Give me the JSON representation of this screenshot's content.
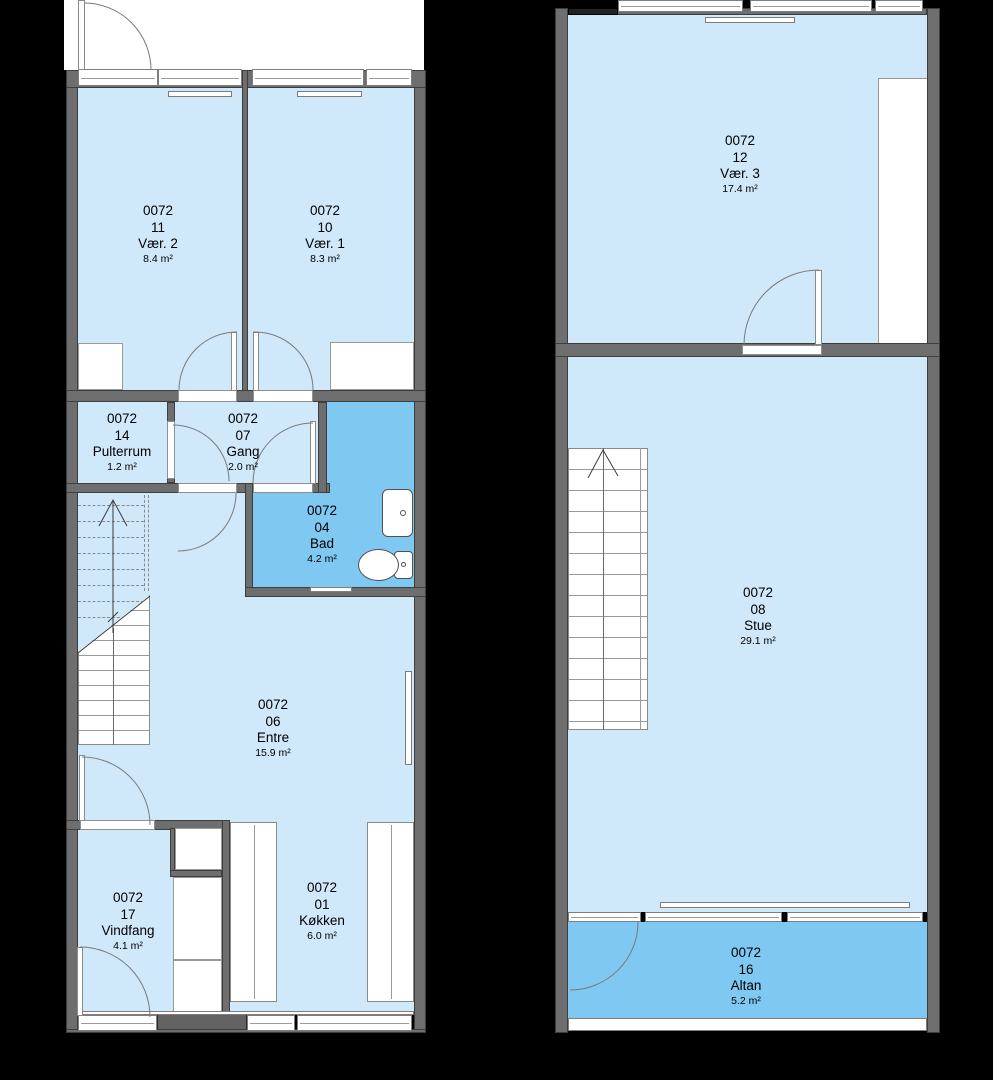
{
  "unit_id": "0072",
  "colors": {
    "background": "#000000",
    "floor_light": "#cfe8fa",
    "floor_dark": "#7fc8f1",
    "wall_gray": "#6e6e6e",
    "wall_edge": "#3e3e3e",
    "fixture_white": "#ffffff",
    "text": "#000000"
  },
  "rooms": {
    "vaer2": {
      "number": "0072",
      "room_no": "11",
      "name": "Vær. 2",
      "area": "8.4 m²"
    },
    "vaer1": {
      "number": "0072",
      "room_no": "10",
      "name": "Vær. 1",
      "area": "8.3 m²"
    },
    "pulterrum": {
      "number": "0072",
      "room_no": "14",
      "name": "Pulterrum",
      "area": "1.2 m²"
    },
    "gang": {
      "number": "0072",
      "room_no": "07",
      "name": "Gang",
      "area": "2.0 m²"
    },
    "bad": {
      "number": "0072",
      "room_no": "04",
      "name": "Bad",
      "area": "4.2 m²"
    },
    "entre": {
      "number": "0072",
      "room_no": "06",
      "name": "Entre",
      "area": "15.9 m²"
    },
    "vindfang": {
      "number": "0072",
      "room_no": "17",
      "name": "Vindfang",
      "area": "4.1 m²"
    },
    "kokken": {
      "number": "0072",
      "room_no": "01",
      "name": "Køkken",
      "area": "6.0 m²"
    },
    "vaer3": {
      "number": "0072",
      "room_no": "12",
      "name": "Vær. 3",
      "area": "17.4 m²"
    },
    "stue": {
      "number": "0072",
      "room_no": "08",
      "name": "Stue",
      "area": "29.1 m²"
    },
    "altan": {
      "number": "0072",
      "room_no": "16",
      "name": "Altan",
      "area": "5.2 m²"
    }
  }
}
